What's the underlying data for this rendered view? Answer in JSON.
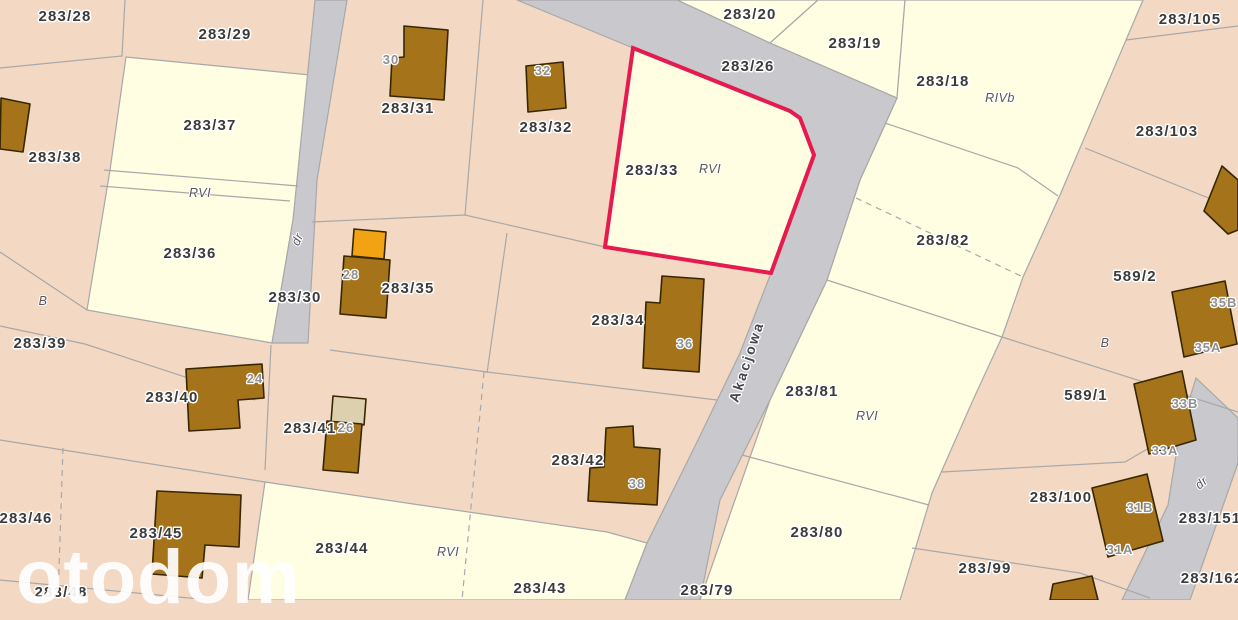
{
  "map": {
    "watermark": "otodom",
    "highlighted_parcel": "283/33",
    "road_name": "Akacjowa",
    "colors": {
      "parcel_pink": "#f3d8c3",
      "parcel_cream": "#fffee3",
      "road": "#c9c9cd",
      "boundary": "#a8a8a8",
      "building": "#a5731a",
      "building_outline": "#362700",
      "building_orange": "#f2a313",
      "building_beige": "#ddd0ae",
      "highlight": "#e51a4f",
      "label_dark": "#3b3b3b",
      "label_building": "#8f9093",
      "label_landuse": "#55565e",
      "label_road": "#45454e"
    },
    "labels": [
      {
        "text": "283/28",
        "type": "parcel",
        "x": 65,
        "y": 21
      },
      {
        "text": "283/29",
        "type": "parcel",
        "x": 225,
        "y": 39
      },
      {
        "text": "283/37",
        "type": "parcel",
        "x": 210,
        "y": 130
      },
      {
        "text": "283/38",
        "type": "parcel",
        "x": 55,
        "y": 162
      },
      {
        "text": "283/31",
        "type": "parcel",
        "x": 408,
        "y": 113
      },
      {
        "text": "283/32",
        "type": "parcel",
        "x": 546,
        "y": 132
      },
      {
        "text": "283/33",
        "type": "parcel",
        "x": 652,
        "y": 175
      },
      {
        "text": "283/20",
        "type": "parcel",
        "x": 750,
        "y": 19
      },
      {
        "text": "283/26",
        "type": "parcel",
        "x": 748,
        "y": 71
      },
      {
        "text": "283/19",
        "type": "parcel",
        "x": 855,
        "y": 48
      },
      {
        "text": "283/18",
        "type": "parcel",
        "x": 943,
        "y": 86
      },
      {
        "text": "283/105",
        "type": "parcel",
        "x": 1190,
        "y": 24
      },
      {
        "text": "283/103",
        "type": "parcel",
        "x": 1167,
        "y": 136
      },
      {
        "text": "283/82",
        "type": "parcel",
        "x": 943,
        "y": 245
      },
      {
        "text": "589/2",
        "type": "parcel",
        "x": 1135,
        "y": 281
      },
      {
        "text": "283/36",
        "type": "parcel",
        "x": 190,
        "y": 258
      },
      {
        "text": "283/30",
        "type": "parcel",
        "x": 295,
        "y": 302
      },
      {
        "text": "283/35",
        "type": "parcel",
        "x": 408,
        "y": 293
      },
      {
        "text": "283/34",
        "type": "parcel",
        "x": 618,
        "y": 325
      },
      {
        "text": "283/39",
        "type": "parcel",
        "x": 40,
        "y": 348
      },
      {
        "text": "283/81",
        "type": "parcel",
        "x": 812,
        "y": 396
      },
      {
        "text": "589/1",
        "type": "parcel",
        "x": 1086,
        "y": 400
      },
      {
        "text": "283/40",
        "type": "parcel",
        "x": 172,
        "y": 402
      },
      {
        "text": "283/41",
        "type": "parcel",
        "x": 310,
        "y": 433
      },
      {
        "text": "283/42",
        "type": "parcel",
        "x": 578,
        "y": 465
      },
      {
        "text": "283/46",
        "type": "parcel",
        "x": 26,
        "y": 523
      },
      {
        "text": "283/45",
        "type": "parcel",
        "x": 156,
        "y": 538
      },
      {
        "text": "283/100",
        "type": "parcel",
        "x": 1061,
        "y": 502
      },
      {
        "text": "283/151",
        "type": "parcel",
        "x": 1210,
        "y": 523
      },
      {
        "text": "283/44",
        "type": "parcel",
        "x": 342,
        "y": 553
      },
      {
        "text": "283/80",
        "type": "parcel",
        "x": 817,
        "y": 537
      },
      {
        "text": "283/99",
        "type": "parcel",
        "x": 985,
        "y": 573
      },
      {
        "text": "283/43",
        "type": "parcel",
        "x": 540,
        "y": 593
      },
      {
        "text": "283/79",
        "type": "parcel",
        "x": 707,
        "y": 595
      },
      {
        "text": "283/48",
        "type": "parcel",
        "x": 61,
        "y": 597
      },
      {
        "text": "283/162",
        "type": "parcel",
        "x": 1212,
        "y": 583
      },
      {
        "text": "RVI",
        "type": "landuse",
        "x": 200,
        "y": 197
      },
      {
        "text": "RVI",
        "type": "landuse",
        "x": 710,
        "y": 173
      },
      {
        "text": "RIVb",
        "type": "landuse",
        "x": 1000,
        "y": 102
      },
      {
        "text": "B",
        "type": "landuse",
        "x": 43,
        "y": 305
      },
      {
        "text": "B",
        "type": "landuse",
        "x": 1105,
        "y": 347
      },
      {
        "text": "RVI",
        "type": "landuse",
        "x": 867,
        "y": 420
      },
      {
        "text": "RVI",
        "type": "landuse",
        "x": 448,
        "y": 556
      },
      {
        "text": "dr",
        "type": "landuse",
        "x": 301,
        "y": 241,
        "rot": -65
      },
      {
        "text": "dr",
        "type": "landuse",
        "x": 1204,
        "y": 486,
        "rot": -40
      },
      {
        "text": "Akacjowa",
        "type": "roadname",
        "x": 751,
        "y": 363,
        "rot": -72
      },
      {
        "text": "30",
        "type": "building",
        "x": 391,
        "y": 64
      },
      {
        "text": "32",
        "type": "building",
        "x": 543,
        "y": 75
      },
      {
        "text": "28",
        "type": "building",
        "x": 351,
        "y": 279
      },
      {
        "text": "36",
        "type": "building",
        "x": 685,
        "y": 348
      },
      {
        "text": "24",
        "type": "building",
        "x": 255,
        "y": 383
      },
      {
        "text": "26",
        "type": "building",
        "x": 346,
        "y": 432
      },
      {
        "text": "38",
        "type": "building",
        "x": 637,
        "y": 488
      },
      {
        "text": "35B",
        "type": "building",
        "x": 1224,
        "y": 307
      },
      {
        "text": "35A",
        "type": "building",
        "x": 1208,
        "y": 352
      },
      {
        "text": "33B",
        "type": "building",
        "x": 1185,
        "y": 408
      },
      {
        "text": "33A",
        "type": "building",
        "x": 1165,
        "y": 455
      },
      {
        "text": "31B",
        "type": "building",
        "x": 1140,
        "y": 512
      },
      {
        "text": "31A",
        "type": "building",
        "x": 1120,
        "y": 554
      }
    ]
  }
}
